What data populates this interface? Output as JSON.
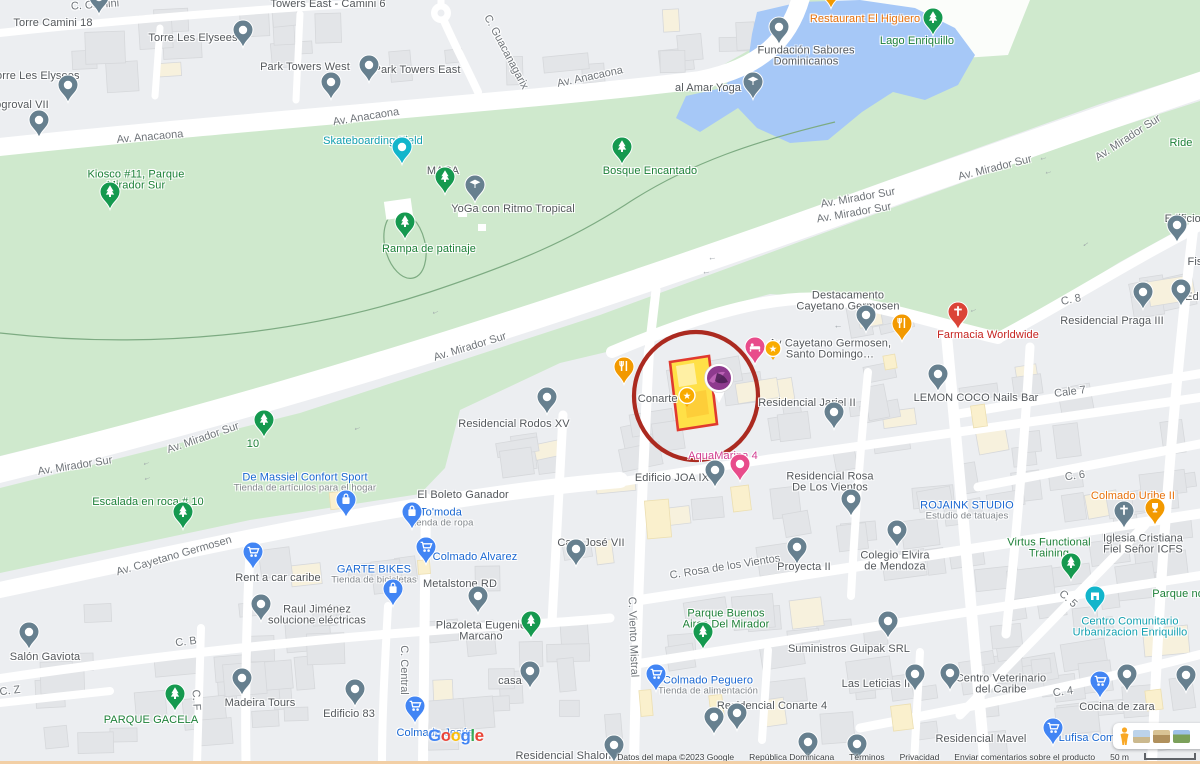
{
  "colors": {
    "urban": "#eceef1",
    "park": "#cfe9cd",
    "water": "#a6c8f7",
    "road": "#ffffff",
    "building": "#e3e5e8",
    "building_stroke": "#d6d8db",
    "cream": "#f7f1dd",
    "annotation_red": "#ab2a20",
    "parcel_fill": "#ffe047",
    "parcel_stroke": "#e03a2f",
    "pin_gray": "#67808f",
    "pin_green": "#15994f",
    "pin_blue": "#4285f4",
    "pin_orange": "#f29900",
    "pin_red": "#db4437",
    "pin_pink": "#e84c8b",
    "pin_teal": "#12b5cb",
    "pin_gold": "#f9ab00",
    "google_letters": [
      "#4285F4",
      "#EA4335",
      "#FBBC05",
      "#4285F4",
      "#34A853",
      "#EA4335"
    ]
  },
  "ui": {
    "google_logo": "Google",
    "photo_card_icons": [
      "pegman-icon",
      "satellite-thumbnail",
      "terrain-thumbnail",
      "imagery-thumbnail"
    ]
  },
  "attribution": {
    "map_data": "Datos del mapa ©2023 Google",
    "region": "República Dominicana",
    "terms": "Términos",
    "privacy": "Privacidad",
    "feedback": "Enviar comentarios sobre el producto",
    "scale": "50 m"
  },
  "annotation": {
    "label": "red-circle-highlight",
    "cx": 696,
    "cy": 396,
    "rx": 62,
    "ry": 64
  },
  "road_labels": [
    {
      "t": "C. Camini",
      "x": 95,
      "y": 5,
      "r": -4
    },
    {
      "t": "Av. Anacaona",
      "x": 150,
      "y": 137,
      "r": -5
    },
    {
      "t": "Av. Anacaona",
      "x": 366,
      "y": 117,
      "r": -9
    },
    {
      "t": "Av. Anacaona",
      "x": 590,
      "y": 77,
      "r": -12
    },
    {
      "t": "C. Guacanagarix",
      "x": 506,
      "y": 52,
      "r": 62
    },
    {
      "t": "Av. Mirador Sur",
      "x": 75,
      "y": 466,
      "r": -9
    },
    {
      "t": "Av. Mirador Sur",
      "x": 203,
      "y": 438,
      "r": -19
    },
    {
      "t": "Av. Mirador Sur",
      "x": 470,
      "y": 347,
      "r": -17
    },
    {
      "t": "Av. Mirador Sur",
      "x": 858,
      "y": 198,
      "r": -10
    },
    {
      "t": "Av. Mirador Sur",
      "x": 854,
      "y": 213,
      "r": -10
    },
    {
      "t": "Av. Mirador Sur",
      "x": 995,
      "y": 168,
      "r": -14
    },
    {
      "t": "Av. Mirador Sur",
      "x": 1128,
      "y": 138,
      "r": -33
    },
    {
      "t": "Av. Cayetano Germosen",
      "x": 174,
      "y": 556,
      "r": -16
    },
    {
      "t": "C. 8",
      "x": 1071,
      "y": 300,
      "r": -12
    },
    {
      "t": "Cale 7",
      "x": 1070,
      "y": 392,
      "r": -7
    },
    {
      "t": "C. 6",
      "x": 1075,
      "y": 476,
      "r": -8
    },
    {
      "t": "C. 5",
      "x": 1068,
      "y": 599,
      "r": 42
    },
    {
      "t": "C. 4",
      "x": 1063,
      "y": 692,
      "r": -8
    },
    {
      "t": "C. Rosa de los Vientos",
      "x": 725,
      "y": 567,
      "r": -9
    },
    {
      "t": "C. B",
      "x": 186,
      "y": 642,
      "r": -7
    },
    {
      "t": "C. Z",
      "x": 10,
      "y": 691,
      "r": -7
    },
    {
      "t": "C. F",
      "x": 196,
      "y": 700,
      "r": 87
    },
    {
      "t": "C. Central",
      "x": 404,
      "y": 670,
      "r": 90
    },
    {
      "t": "C. Viento Mistral",
      "x": 633,
      "y": 637,
      "r": 88
    }
  ],
  "arrows": [
    {
      "x": 146,
      "y": 462,
      "r": -18
    },
    {
      "x": 147,
      "y": 477,
      "r": -18
    },
    {
      "x": 357,
      "y": 427,
      "r": -18
    },
    {
      "x": 435,
      "y": 311,
      "r": -17
    },
    {
      "x": 712,
      "y": 257,
      "r": -10
    },
    {
      "x": 706,
      "y": 271,
      "r": -10
    },
    {
      "x": 1043,
      "y": 157,
      "r": -14
    },
    {
      "x": 1048,
      "y": 171,
      "r": -14
    },
    {
      "x": 1085,
      "y": 243,
      "r": -35
    },
    {
      "x": 973,
      "y": 309,
      "r": -20
    },
    {
      "x": 838,
      "y": 325,
      "r": 0
    }
  ],
  "pois": [
    {
      "x": 53,
      "y": 23,
      "l": [
        [
          "Torre Camini 18",
          "g"
        ]
      ]
    },
    {
      "x": 328,
      "y": 4,
      "l": [
        [
          "Towers East - Camini 6",
          "g"
        ]
      ]
    },
    {
      "x": 193,
      "y": 38,
      "l": [
        [
          "Torre Les Elysees",
          "g"
        ]
      ]
    },
    {
      "x": 35,
      "y": 76,
      "l": [
        [
          "Torre Les Elysees",
          "g"
        ]
      ]
    },
    {
      "x": 22,
      "y": 105,
      "l": [
        [
          "ogroval VII",
          "g"
        ]
      ]
    },
    {
      "x": 305,
      "y": 67,
      "l": [
        [
          "Park Towers West",
          "g"
        ]
      ]
    },
    {
      "x": 417,
      "y": 70,
      "l": [
        [
          "Park Towers East",
          "g"
        ]
      ]
    },
    {
      "x": 865,
      "y": 19,
      "l": [
        [
          "Restaurant El Higüero",
          "o"
        ]
      ]
    },
    {
      "x": 917,
      "y": 41,
      "l": [
        [
          "Lago Enriquillo",
          "gr"
        ]
      ]
    },
    {
      "x": 806,
      "y": 56,
      "l": [
        [
          "Fundación Sabores",
          "g"
        ],
        [
          "Dominicanos",
          "g"
        ]
      ]
    },
    {
      "x": 708,
      "y": 88,
      "l": [
        [
          "al Amar Yoga",
          "g"
        ]
      ]
    },
    {
      "x": 373,
      "y": 141,
      "l": [
        [
          "Skateboarding Field",
          "t"
        ]
      ]
    },
    {
      "x": 136,
      "y": 180,
      "l": [
        [
          "Kiosco #11, Parque",
          "gr"
        ],
        [
          "Mirador Sur",
          "gr"
        ]
      ]
    },
    {
      "x": 443,
      "y": 171,
      "l": [
        [
          "MACA",
          "g"
        ]
      ]
    },
    {
      "x": 513,
      "y": 209,
      "l": [
        [
          "YoGa con Ritmo Tropical",
          "g"
        ]
      ]
    },
    {
      "x": 650,
      "y": 171,
      "l": [
        [
          "Bosque Encantado",
          "gr"
        ]
      ]
    },
    {
      "x": 429,
      "y": 249,
      "l": [
        [
          "Rampa de patinaje",
          "gr"
        ]
      ]
    },
    {
      "x": 253,
      "y": 444,
      "l": [
        [
          "10",
          "gr"
        ]
      ]
    },
    {
      "x": 148,
      "y": 502,
      "l": [
        [
          "Escalada en roca # 10",
          "gr"
        ]
      ]
    },
    {
      "x": 305,
      "y": 483,
      "l": [
        [
          "De Massiel Confort Sport",
          "b"
        ],
        [
          "Tienda de artículos para el hogar",
          "s"
        ]
      ]
    },
    {
      "x": 848,
      "y": 301,
      "l": [
        [
          "Destacamento",
          "g"
        ],
        [
          "Cayetano Germosen",
          "g"
        ]
      ]
    },
    {
      "x": 830,
      "y": 349,
      "l": [
        [
          "Av Cayetano Germosen,",
          "g"
        ],
        [
          "Santo Domingo…",
          "g"
        ]
      ]
    },
    {
      "x": 663,
      "y": 399,
      "l": [
        [
          "Conarte V",
          "g"
        ]
      ]
    },
    {
      "x": 807,
      "y": 403,
      "l": [
        [
          "Residencial Jariel II",
          "g"
        ]
      ]
    },
    {
      "x": 988,
      "y": 335,
      "l": [
        [
          "Farmacia Worldwide",
          "r"
        ]
      ]
    },
    {
      "x": 976,
      "y": 398,
      "l": [
        [
          "LEMON COCO Nails Bar",
          "g"
        ]
      ]
    },
    {
      "x": 1112,
      "y": 321,
      "l": [
        [
          "Residencial Praga III",
          "g"
        ]
      ]
    },
    {
      "x": 1188,
      "y": 219,
      "l": [
        [
          "Edificio E",
          "g"
        ]
      ]
    },
    {
      "x": 1195,
      "y": 262,
      "l": [
        [
          "Fis",
          "g"
        ]
      ]
    },
    {
      "x": 1192,
      "y": 297,
      "l": [
        [
          "Ed",
          "g"
        ]
      ]
    },
    {
      "x": 1181,
      "y": 143,
      "l": [
        [
          "Ride",
          "gr"
        ]
      ]
    },
    {
      "x": 514,
      "y": 424,
      "l": [
        [
          "Residencial Rodos XV",
          "g"
        ]
      ]
    },
    {
      "x": 723,
      "y": 456,
      "l": [
        [
          "AquaMarina 4",
          "p"
        ]
      ]
    },
    {
      "x": 672,
      "y": 478,
      "l": [
        [
          "Edificio JOA IX",
          "g"
        ]
      ]
    },
    {
      "x": 830,
      "y": 482,
      "l": [
        [
          "Residencial Rosa",
          "g"
        ],
        [
          "De Los Vientos",
          "g"
        ]
      ]
    },
    {
      "x": 804,
      "y": 567,
      "l": [
        [
          "Proyecta II",
          "g"
        ]
      ]
    },
    {
      "x": 895,
      "y": 561,
      "l": [
        [
          "Colegio Elvira",
          "g"
        ],
        [
          "de Mendoza",
          "g"
        ]
      ]
    },
    {
      "x": 463,
      "y": 495,
      "l": [
        [
          "El Boleto Ganador",
          "g"
        ]
      ]
    },
    {
      "x": 441,
      "y": 518,
      "l": [
        [
          "To'moda",
          "b"
        ],
        [
          "Tienda de ropa",
          "s"
        ]
      ]
    },
    {
      "x": 475,
      "y": 557,
      "l": [
        [
          "Colmado Alvarez",
          "b"
        ]
      ]
    },
    {
      "x": 374,
      "y": 575,
      "l": [
        [
          "GARTE BIKES",
          "b"
        ],
        [
          "Tienda de bicicletas",
          "s"
        ]
      ]
    },
    {
      "x": 460,
      "y": 584,
      "l": [
        [
          "Metalstone RD",
          "g"
        ]
      ]
    },
    {
      "x": 317,
      "y": 615,
      "l": [
        [
          "Raul Jiménez",
          "g"
        ],
        [
          "solucione eléctricas",
          "g"
        ]
      ]
    },
    {
      "x": 278,
      "y": 578,
      "l": [
        [
          "Rent a car caribe",
          "g"
        ]
      ]
    },
    {
      "x": 45,
      "y": 657,
      "l": [
        [
          "Salón Gaviota",
          "g"
        ]
      ]
    },
    {
      "x": 151,
      "y": 720,
      "l": [
        [
          "PARQUE GACELA",
          "gr"
        ]
      ]
    },
    {
      "x": 260,
      "y": 703,
      "l": [
        [
          "Madeira Tours",
          "g"
        ]
      ]
    },
    {
      "x": 349,
      "y": 714,
      "l": [
        [
          "Edificio 83",
          "g"
        ]
      ]
    },
    {
      "x": 481,
      "y": 631,
      "l": [
        [
          "Plazoleta Eugenio",
          "g"
        ],
        [
          "Marcano",
          "g"
        ]
      ]
    },
    {
      "x": 510,
      "y": 681,
      "l": [
        [
          "casa",
          "g"
        ]
      ]
    },
    {
      "x": 435,
      "y": 733,
      "l": [
        [
          "Colmado Jesús",
          "b"
        ]
      ]
    },
    {
      "x": 591,
      "y": 543,
      "l": [
        [
          "Cary José VII",
          "g"
        ]
      ]
    },
    {
      "x": 726,
      "y": 619,
      "l": [
        [
          "Parque Buenos",
          "gr"
        ],
        [
          "Aires Del Mirador",
          "gr"
        ]
      ]
    },
    {
      "x": 708,
      "y": 686,
      "l": [
        [
          "Colmado Peguero",
          "b"
        ],
        [
          "Tienda de alimentación",
          "s"
        ]
      ]
    },
    {
      "x": 772,
      "y": 706,
      "l": [
        [
          "Residencial Conarte 4",
          "g"
        ]
      ]
    },
    {
      "x": 849,
      "y": 649,
      "l": [
        [
          "Suministros Guipak SRL",
          "g"
        ]
      ]
    },
    {
      "x": 876,
      "y": 684,
      "l": [
        [
          "Las Leticias II",
          "g"
        ]
      ]
    },
    {
      "x": 1001,
      "y": 684,
      "l": [
        [
          "Centro Veterinario",
          "g"
        ],
        [
          "del Caribe",
          "g"
        ]
      ]
    },
    {
      "x": 1117,
      "y": 707,
      "l": [
        [
          "Cocina de zara",
          "g"
        ]
      ]
    },
    {
      "x": 1130,
      "y": 627,
      "l": [
        [
          "Centro Comunitario",
          "t"
        ],
        [
          "Urbanizacion Enriquillo",
          "t"
        ]
      ]
    },
    {
      "x": 1180,
      "y": 594,
      "l": [
        [
          "Parque nor",
          "gr"
        ]
      ]
    },
    {
      "x": 967,
      "y": 511,
      "l": [
        [
          "ROJAINK STUDIO",
          "b"
        ],
        [
          "Estudio de tatuajes",
          "s"
        ]
      ]
    },
    {
      "x": 1049,
      "y": 548,
      "l": [
        [
          "Virtus Functional",
          "gr"
        ],
        [
          "Training",
          "gr"
        ]
      ]
    },
    {
      "x": 1143,
      "y": 544,
      "l": [
        [
          "Iglesia Cristiana",
          "g"
        ],
        [
          "Fiel Señor ICFS",
          "g"
        ]
      ]
    },
    {
      "x": 1133,
      "y": 496,
      "l": [
        [
          "Colmado Uribe II",
          "o"
        ]
      ]
    },
    {
      "x": 565,
      "y": 756,
      "l": [
        [
          "Residencial Shalom",
          "g"
        ]
      ]
    },
    {
      "x": 981,
      "y": 739,
      "l": [
        [
          "Residencial Mavel",
          "g"
        ]
      ]
    },
    {
      "x": 1087,
      "y": 738,
      "l": [
        [
          "Lufisa Com",
          "b"
        ]
      ]
    }
  ],
  "pins": [
    {
      "x": 99,
      "y": 15,
      "t": "dot",
      "c": "gray"
    },
    {
      "x": 243,
      "y": 48,
      "t": "dot",
      "c": "gray"
    },
    {
      "x": 68,
      "y": 103,
      "t": "dot",
      "c": "gray"
    },
    {
      "x": 39,
      "y": 138,
      "t": "dot",
      "c": "gray"
    },
    {
      "x": 331,
      "y": 100,
      "t": "dot",
      "c": "gray"
    },
    {
      "x": 369,
      "y": 83,
      "t": "dot",
      "c": "gray"
    },
    {
      "x": 779,
      "y": 45,
      "t": "dot",
      "c": "gray"
    },
    {
      "x": 831,
      "y": 9,
      "t": "food",
      "c": "orange"
    },
    {
      "x": 933,
      "y": 36,
      "t": "tree",
      "c": "green"
    },
    {
      "x": 753,
      "y": 100,
      "t": "cap",
      "c": "gray"
    },
    {
      "x": 402,
      "y": 165,
      "t": "dot",
      "c": "teal"
    },
    {
      "x": 110,
      "y": 210,
      "t": "tree",
      "c": "green"
    },
    {
      "x": 445,
      "y": 195,
      "t": "tree",
      "c": "green"
    },
    {
      "x": 475,
      "y": 203,
      "t": "cap",
      "c": "gray"
    },
    {
      "x": 622,
      "y": 165,
      "t": "tree",
      "c": "green"
    },
    {
      "x": 405,
      "y": 240,
      "t": "tree",
      "c": "green"
    },
    {
      "x": 264,
      "y": 438,
      "t": "tree",
      "c": "green"
    },
    {
      "x": 183,
      "y": 530,
      "t": "tree",
      "c": "green"
    },
    {
      "x": 346,
      "y": 518,
      "t": "bag",
      "c": "blue"
    },
    {
      "x": 866,
      "y": 333,
      "t": "dot",
      "c": "gray"
    },
    {
      "x": 902,
      "y": 342,
      "t": "food",
      "c": "orange"
    },
    {
      "x": 755,
      "y": 365,
      "t": "bed",
      "c": "pink"
    },
    {
      "x": 624,
      "y": 385,
      "t": "food",
      "c": "orange"
    },
    {
      "x": 834,
      "y": 430,
      "t": "dot",
      "c": "gray"
    },
    {
      "x": 958,
      "y": 330,
      "t": "cross",
      "c": "red"
    },
    {
      "x": 938,
      "y": 392,
      "t": "dot",
      "c": "gray"
    },
    {
      "x": 1143,
      "y": 310,
      "t": "dot",
      "c": "gray"
    },
    {
      "x": 1177,
      "y": 243,
      "t": "dot",
      "c": "gray"
    },
    {
      "x": 1181,
      "y": 307,
      "t": "dot",
      "c": "gray"
    },
    {
      "x": 547,
      "y": 415,
      "t": "dot",
      "c": "gray"
    },
    {
      "x": 740,
      "y": 482,
      "t": "dot",
      "c": "pink"
    },
    {
      "x": 715,
      "y": 488,
      "t": "dot",
      "c": "gray"
    },
    {
      "x": 851,
      "y": 517,
      "t": "dot",
      "c": "gray"
    },
    {
      "x": 797,
      "y": 565,
      "t": "dot",
      "c": "gray"
    },
    {
      "x": 897,
      "y": 548,
      "t": "dot",
      "c": "gray"
    },
    {
      "x": 412,
      "y": 530,
      "t": "bag",
      "c": "blue"
    },
    {
      "x": 426,
      "y": 565,
      "t": "cart",
      "c": "blue"
    },
    {
      "x": 393,
      "y": 607,
      "t": "bag",
      "c": "blue"
    },
    {
      "x": 478,
      "y": 614,
      "t": "dot",
      "c": "gray"
    },
    {
      "x": 261,
      "y": 622,
      "t": "dot",
      "c": "gray"
    },
    {
      "x": 253,
      "y": 570,
      "t": "cart",
      "c": "blue"
    },
    {
      "x": 29,
      "y": 650,
      "t": "dot",
      "c": "gray"
    },
    {
      "x": 175,
      "y": 712,
      "t": "tree",
      "c": "green"
    },
    {
      "x": 242,
      "y": 696,
      "t": "dot",
      "c": "gray"
    },
    {
      "x": 355,
      "y": 707,
      "t": "dot",
      "c": "gray"
    },
    {
      "x": 531,
      "y": 639,
      "t": "tree",
      "c": "green"
    },
    {
      "x": 530,
      "y": 689,
      "t": "dot",
      "c": "gray"
    },
    {
      "x": 415,
      "y": 724,
      "t": "cart",
      "c": "blue"
    },
    {
      "x": 576,
      "y": 567,
      "t": "dot",
      "c": "gray"
    },
    {
      "x": 703,
      "y": 650,
      "t": "tree",
      "c": "green"
    },
    {
      "x": 656,
      "y": 692,
      "t": "cart",
      "c": "blue"
    },
    {
      "x": 737,
      "y": 731,
      "t": "dot",
      "c": "gray"
    },
    {
      "x": 888,
      "y": 639,
      "t": "dot",
      "c": "gray"
    },
    {
      "x": 915,
      "y": 692,
      "t": "dot",
      "c": "gray"
    },
    {
      "x": 950,
      "y": 691,
      "t": "dot",
      "c": "gray"
    },
    {
      "x": 1100,
      "y": 699,
      "t": "cart",
      "c": "blue"
    },
    {
      "x": 1095,
      "y": 614,
      "t": "comm",
      "c": "teal"
    },
    {
      "x": 1071,
      "y": 581,
      "t": "tree",
      "c": "green"
    },
    {
      "x": 1124,
      "y": 529,
      "t": "cross",
      "c": "gray"
    },
    {
      "x": 1155,
      "y": 526,
      "t": "cup",
      "c": "orange"
    },
    {
      "x": 1053,
      "y": 746,
      "t": "cart",
      "c": "blue"
    },
    {
      "x": 614,
      "y": 763,
      "t": "dot",
      "c": "gray"
    },
    {
      "x": 714,
      "y": 735,
      "t": "dot",
      "c": "gray"
    },
    {
      "x": 808,
      "y": 760,
      "t": "dot",
      "c": "gray"
    },
    {
      "x": 857,
      "y": 762,
      "t": "dot",
      "c": "gray"
    },
    {
      "x": 1127,
      "y": 692,
      "t": "dot",
      "c": "gray"
    },
    {
      "x": 1186,
      "y": 693,
      "t": "dot",
      "c": "gray"
    },
    {
      "x": 773,
      "y": 350,
      "t": "star",
      "c": "gold"
    },
    {
      "x": 687,
      "y": 397,
      "t": "star",
      "c": "gold"
    },
    {
      "x": 719,
      "y": 379,
      "t": "photo",
      "c": "purple"
    }
  ]
}
